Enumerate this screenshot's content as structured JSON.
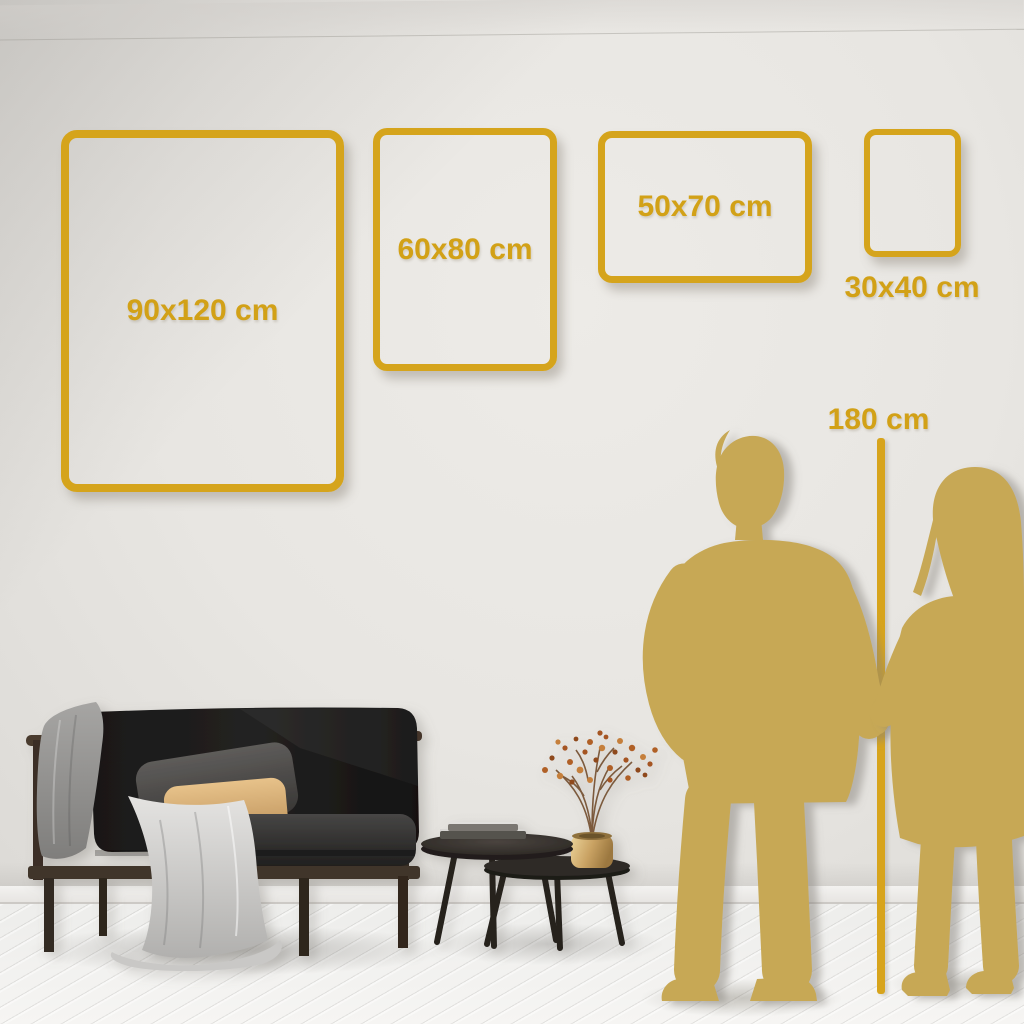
{
  "page": {
    "description": "Wall art size comparison guide shown on a living-room wall"
  },
  "colors": {
    "frame_gold": "#D5A41C",
    "label_gold": "#D2A117",
    "silhouette_gold": "#C7A855",
    "wall": "#E9E7E3",
    "floor": "#F2F1EE"
  },
  "size_frames": [
    {
      "id": "90x120",
      "label": "90x120 cm",
      "label_position": "inside"
    },
    {
      "id": "60x80",
      "label": "60x80 cm",
      "label_position": "inside"
    },
    {
      "id": "50x70",
      "label": "50x70 cm",
      "label_position": "inside"
    },
    {
      "id": "30x40",
      "label": "30x40 cm",
      "label_position": "below"
    }
  ],
  "height_reference": {
    "label": "180 cm"
  },
  "scene": {
    "objects": [
      "dark-sofa",
      "gray-blanket",
      "dark-pillow",
      "tan-pillow",
      "nesting-coffee-tables",
      "books",
      "gold-vase-dried-plant",
      "man-silhouette",
      "woman-silhouette",
      "plank-floor"
    ]
  }
}
